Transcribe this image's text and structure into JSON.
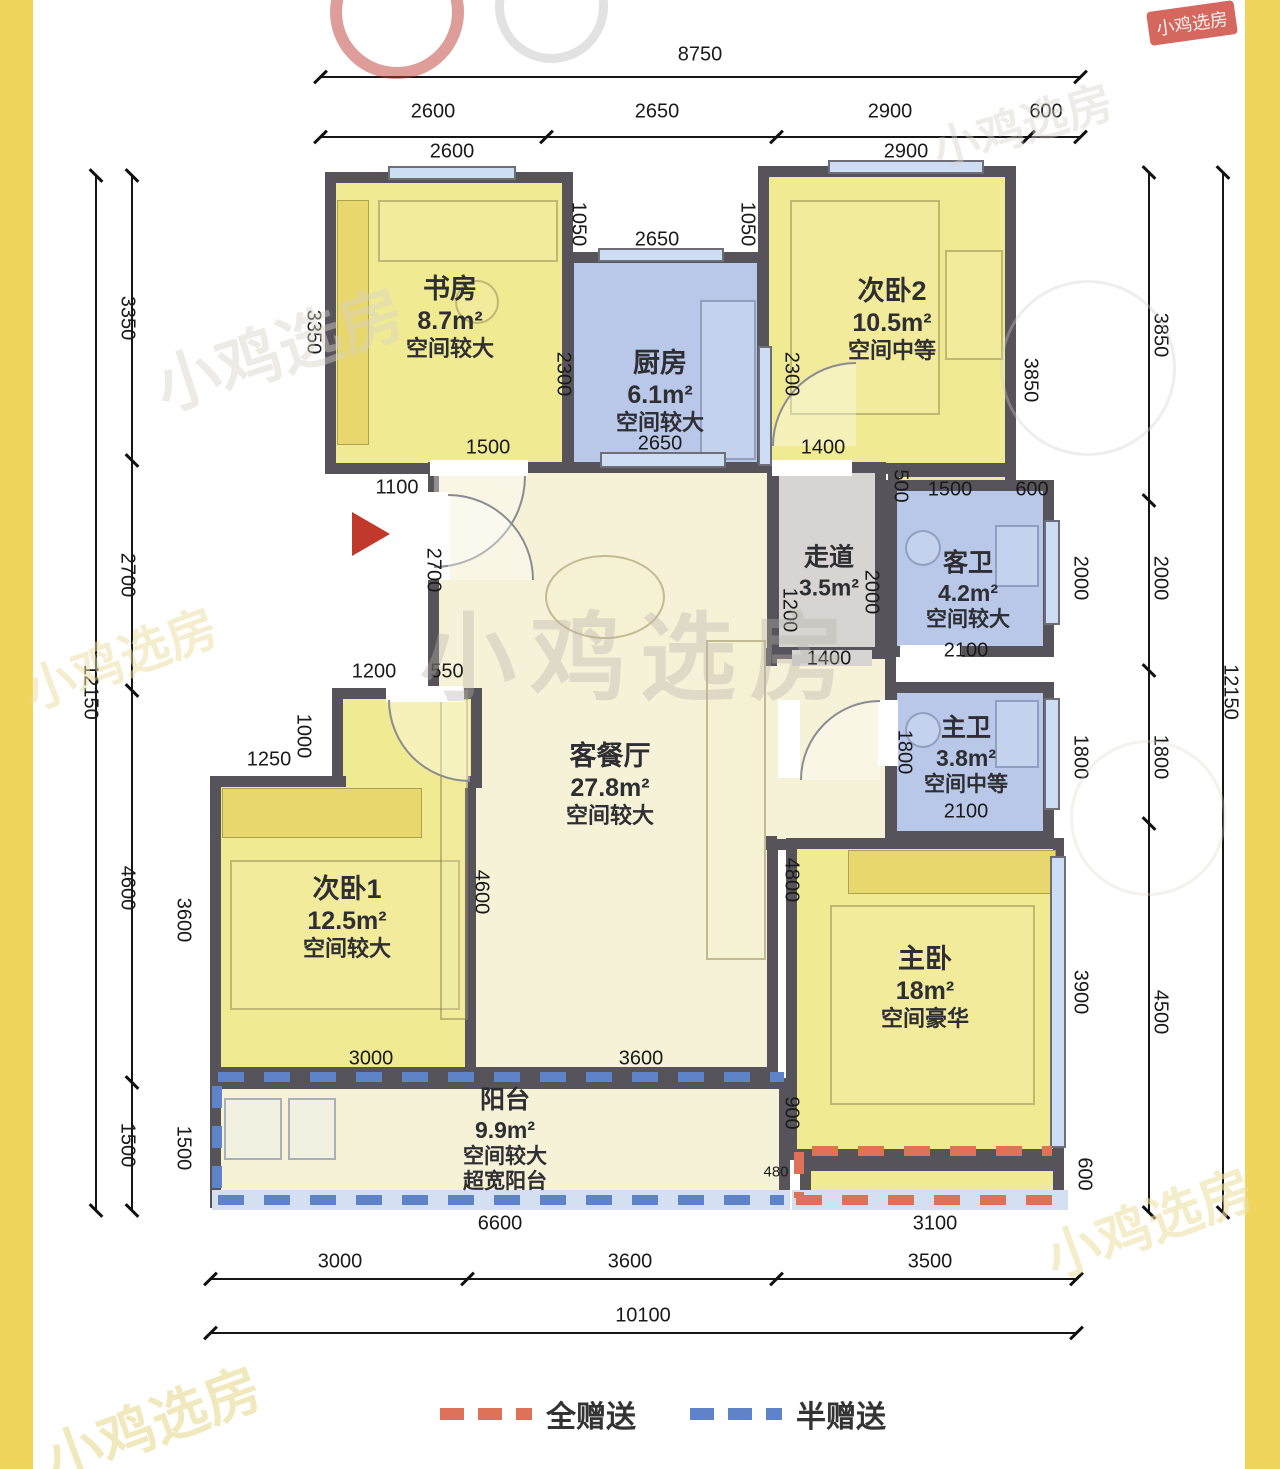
{
  "watermark": {
    "text": "小鸡选房"
  },
  "legend": {
    "full_gift": "全赠送",
    "half_gift": "半赠送"
  },
  "rooms": {
    "study": {
      "name": "书房",
      "area": "8.7m²",
      "note": "空间较大"
    },
    "kitchen": {
      "name": "厨房",
      "area": "6.1m²",
      "note": "空间较大"
    },
    "bed2": {
      "name": "次卧2",
      "area": "10.5m²",
      "note": "空间中等"
    },
    "corridor": {
      "name": "走道",
      "area": "3.5m²",
      "note": ""
    },
    "gbath": {
      "name": "客卫",
      "area": "4.2m²",
      "note": "空间较大"
    },
    "mbath": {
      "name": "主卫",
      "area": "3.8m²",
      "note": "空间中等"
    },
    "living": {
      "name": "客餐厅",
      "area": "27.8m²",
      "note": "空间较大"
    },
    "bed1": {
      "name": "次卧1",
      "area": "12.5m²",
      "note": "空间较大"
    },
    "master": {
      "name": "主卧",
      "area": "18m²",
      "note": "空间豪华"
    },
    "balcony": {
      "name": "阳台",
      "area": "9.9m²",
      "note": "空间较大",
      "note2": "超宽阳台"
    }
  },
  "dims": {
    "top_total": "8750",
    "top_s1": "2600",
    "top_s2": "2650",
    "top_s3": "2900",
    "top_s4": "600",
    "win_study": "2600",
    "win_bed2": "2900",
    "left_total": "12150",
    "left_s1": "3350",
    "left_s2": "2700",
    "left_s3": "4600",
    "left_s4": "1500",
    "left_in_3600": "3600",
    "left_in_1500": "1500",
    "right_total": "12150",
    "right_s1": "3850",
    "right_s2": "2000",
    "right_s3": "1800",
    "right_s4": "4500",
    "right_in_3850": "3850",
    "right_in_2000": "2000",
    "right_in_1800": "1800",
    "right_in_3900": "3900",
    "right_in_600": "600",
    "bot_s1": "3000",
    "bot_s2": "3600",
    "bot_s3": "3500",
    "bot_total": "10100",
    "bot_in_6600": "6600",
    "bot_in_3100": "3100",
    "study_left": "3350",
    "study_top": "1050",
    "bed2_top": "1050",
    "kitchen_win": "2650",
    "kitchen_left": "2300",
    "bed2_left": "2300",
    "study_bot": "1500",
    "kitchen_bot": "2650",
    "bed2_bot": "1400",
    "shaft": "500",
    "bay": "1500",
    "bay_right": "600",
    "entry_top": "1100",
    "entry_mid": "2700",
    "step_1200": "1200",
    "step_550": "550",
    "bed1_1000": "1000",
    "bed1_1250": "1250",
    "bed1_right": "4600",
    "living_right": "4800",
    "corr_1200": "1200",
    "corr_2000": "2000",
    "corr_bot": "1400",
    "gbath_bot": "2100",
    "mbath_left": "1800",
    "mbath_bot": "2100",
    "bed1_bot": "3000",
    "living_bot": "3600",
    "master_900": "900",
    "master_480": "480"
  }
}
